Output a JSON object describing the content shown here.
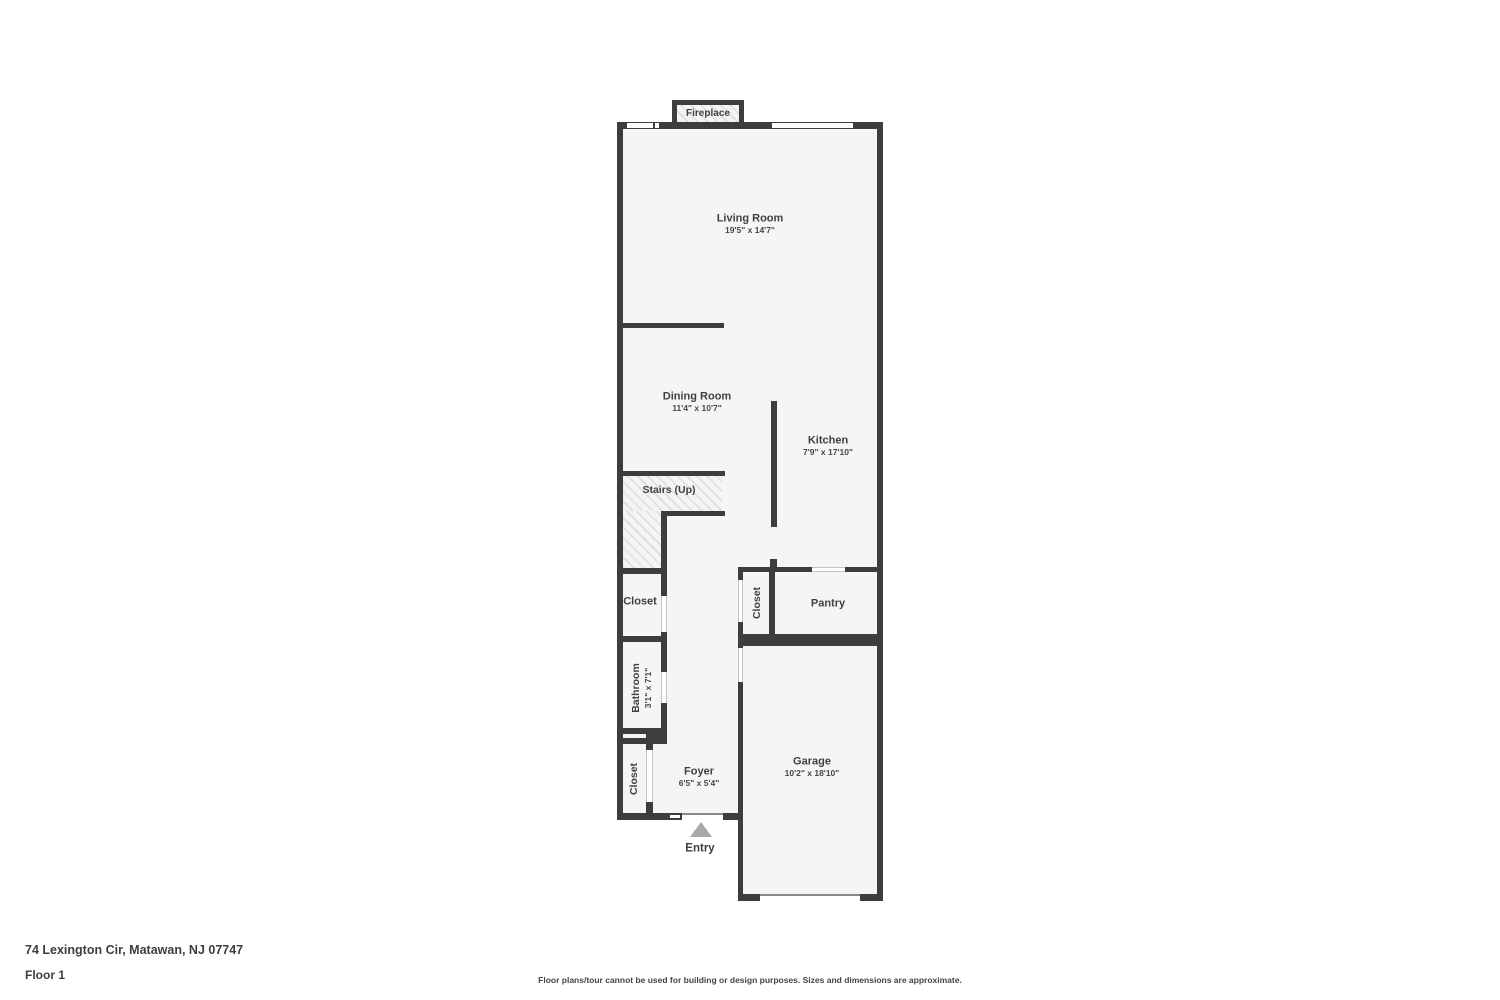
{
  "floorplan": {
    "fireplace_label": "Fireplace",
    "entry_label": "Entry",
    "rooms": {
      "living": {
        "name": "Living Room",
        "dims": "19'5\" x 14'7\""
      },
      "dining": {
        "name": "Dining Room",
        "dims": "11'4\" x 10'7\""
      },
      "kitchen": {
        "name": "Kitchen",
        "dims": "7'9\" x 17'10\""
      },
      "stairs": {
        "name": "Stairs (Up)"
      },
      "closet_hall": {
        "name": "Closet"
      },
      "closet_pantry": {
        "name": "Closet"
      },
      "pantry": {
        "name": "Pantry"
      },
      "bathroom": {
        "name": "Bathroom",
        "dims": "3'1\" x 7'1\""
      },
      "closet_foyer": {
        "name": "Closet"
      },
      "foyer": {
        "name": "Foyer",
        "dims": "6'5\" x 5'4\""
      },
      "garage": {
        "name": "Garage",
        "dims": "10'2\" x 18'10\""
      }
    },
    "colors": {
      "wall": "#3d3d3d",
      "room_fill": "#f5f5f5",
      "hatch_line": "#dedede",
      "entry_arrow": "#a9a9a9",
      "text": "#3f3f3f"
    }
  },
  "footer": {
    "address": "74 Lexington Cir, Matawan, NJ 07747",
    "floor": "Floor 1",
    "disclaimer": "Floor plans/tour cannot be used for building or design purposes. Sizes and dimensions are approximate."
  }
}
